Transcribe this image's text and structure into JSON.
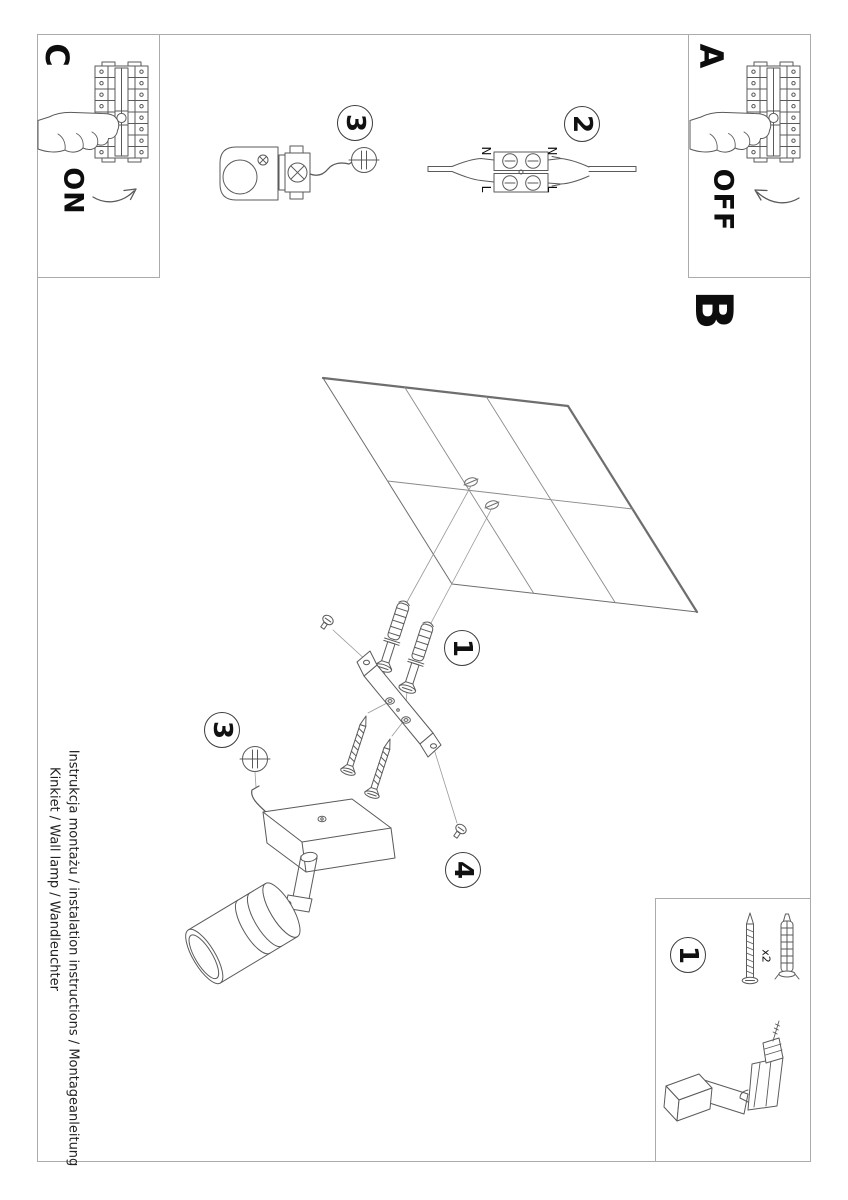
{
  "page": {
    "background": "#ffffff",
    "border_color": "#ababab",
    "line_color": "#5a5a5a",
    "text_color": "#111111"
  },
  "sections": {
    "a": {
      "label": "A",
      "state": "OFF"
    },
    "b": {
      "label": "B"
    },
    "c": {
      "label": "C",
      "state": "ON"
    }
  },
  "badges": {
    "top_step3": "3",
    "top_step2": "2",
    "mid_step1": "1",
    "mid_step3": "3",
    "mid_step4": "4",
    "parts_step1": "1"
  },
  "wiring": {
    "n_left": "N",
    "n_right": "N",
    "l_left": "L",
    "l_right": "L"
  },
  "parts_box": {
    "quantity": "x2"
  },
  "caption": {
    "line1": "Instrukcja montażu / instalation instructions / Montageanleitung",
    "line2": "Kinkiet / Wall lamp / Wandleuchter"
  }
}
